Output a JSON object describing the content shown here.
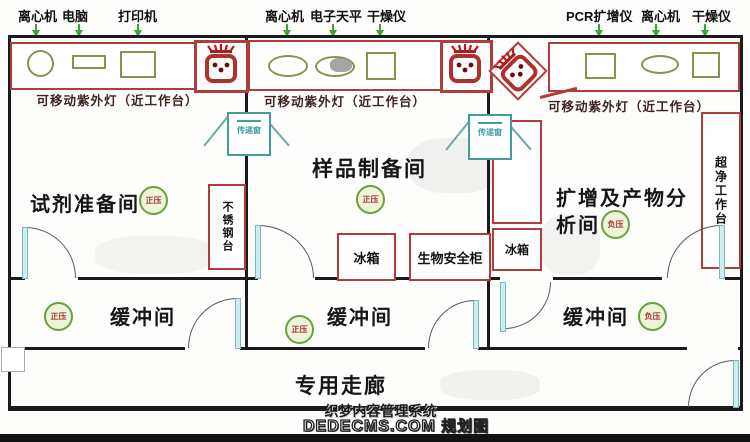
{
  "diagram_title_hidden": "规划图",
  "watermark": {
    "line1": "织梦内容管理系统",
    "line2": "DEDECMS.COM",
    "line2_suffix": "规划图"
  },
  "equipment_labels": {
    "room1": [
      "离心机",
      "电脑",
      "打印机"
    ],
    "room2": [
      "离心机",
      "电子天平",
      "干燥仪"
    ],
    "room3": [
      "PCR扩增仪",
      "离心机",
      "干燥仪"
    ]
  },
  "uv_note": "可移动紫外灯（近工作台）",
  "rooms": {
    "reagent": {
      "name": "试剂准备间",
      "pressure": "正压"
    },
    "sample": {
      "name": "样品制备间",
      "pressure": "正压"
    },
    "amplification": {
      "name": "扩增及产物分析间",
      "pressure": "负压"
    }
  },
  "buffers": [
    {
      "name": "缓冲间",
      "pressure": "正压"
    },
    {
      "name": "缓冲间",
      "pressure": "正压"
    },
    {
      "name": "缓冲间",
      "pressure": "负压"
    }
  ],
  "corridor": {
    "name": "专用走廊"
  },
  "furniture": {
    "pass_box": "传递窗",
    "stainless_table": "不锈钢台",
    "fridge": "冰箱",
    "bio_safety_cabinet": "生物安全柜",
    "clean_bench": "超净工作台"
  },
  "colors": {
    "wall": "#1b1b1b",
    "bench_red": "#b23b3b",
    "sink_red": "#b03030",
    "equipment_olive": "#8a9150",
    "teal": "#3f9f9f",
    "badge_green": "#69a23b",
    "arrow_green": "#3aa43a"
  }
}
